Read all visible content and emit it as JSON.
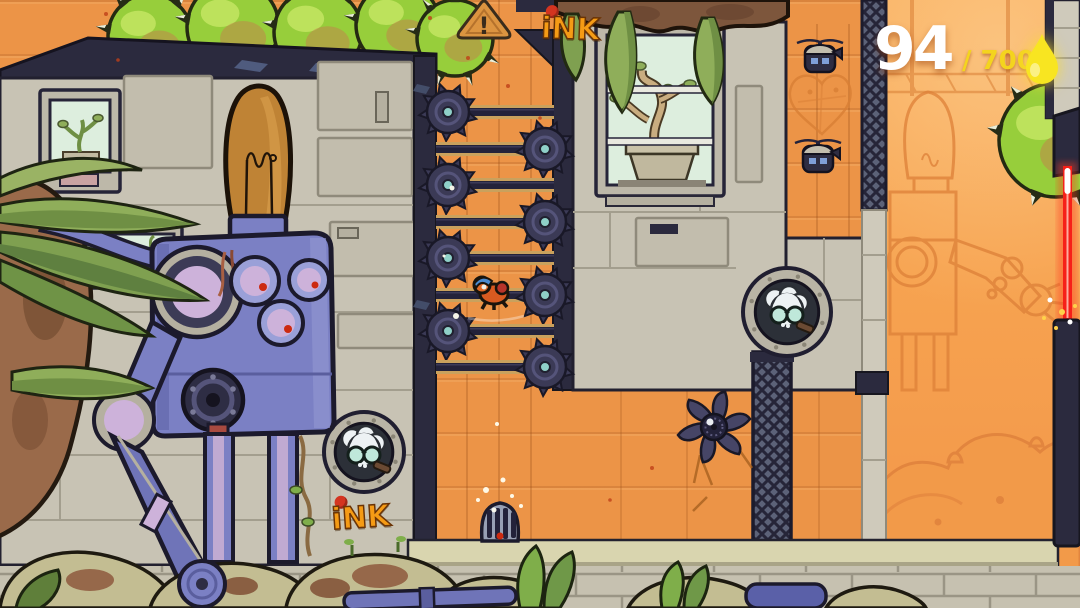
{
  "hud": {
    "ink_count": "94",
    "ink_total": "/ 700",
    "count_color": "#ffffff",
    "total_color": "#f4d41e",
    "droplet_color": "#f8e521"
  },
  "branding": {
    "ink_logo_text": "iNK",
    "ink_logo_color": "#f59b15",
    "ink_logo_dot_color": "#d43420"
  },
  "signs": {
    "warning_text": "!"
  },
  "level": {
    "rails": [
      {
        "y": 112,
        "saw": "left"
      },
      {
        "y": 149,
        "saw": "right"
      },
      {
        "y": 185,
        "saw": "left"
      },
      {
        "y": 222,
        "saw": "right"
      },
      {
        "y": 258,
        "saw": "left"
      },
      {
        "y": 295,
        "saw": "right"
      },
      {
        "y": 331,
        "saw": "left"
      },
      {
        "y": 367,
        "saw": "right"
      }
    ],
    "player": {
      "x": 472,
      "y": 272
    },
    "drones": [
      {
        "x": 797,
        "y": 36
      },
      {
        "x": 795,
        "y": 136
      }
    ],
    "skull_windows": [
      {
        "cx": 364,
        "cy": 452,
        "r": 40
      },
      {
        "cx": 787,
        "cy": 312,
        "r": 44
      }
    ],
    "green_blobs": [
      {
        "cx": 150,
        "cy": 36,
        "r": 42
      },
      {
        "cx": 233,
        "cy": 27,
        "r": 46
      },
      {
        "cx": 318,
        "cy": 32,
        "r": 44
      },
      {
        "cx": 398,
        "cy": 25,
        "r": 42
      },
      {
        "cx": 455,
        "cy": 38,
        "r": 38
      },
      {
        "cx": 1056,
        "cy": 140,
        "r": 57
      }
    ],
    "sparkles": [
      {
        "x": 452,
        "y": 188,
        "r": 2.5
      },
      {
        "x": 456,
        "y": 316,
        "r": 3
      },
      {
        "x": 444,
        "y": 256,
        "r": 1.5
      },
      {
        "x": 497,
        "y": 424,
        "r": 2
      },
      {
        "x": 486,
        "y": 490,
        "r": 3
      },
      {
        "x": 503,
        "y": 480,
        "r": 2.5
      },
      {
        "x": 512,
        "y": 496,
        "r": 2
      },
      {
        "x": 478,
        "y": 500,
        "r": 2
      },
      {
        "x": 494,
        "y": 510,
        "r": 2.5
      },
      {
        "x": 521,
        "y": 506,
        "r": 2
      }
    ],
    "laser_sparks": [
      {
        "x": 1050,
        "y": 300,
        "r": 2.5
      },
      {
        "x": 1062,
        "y": 312,
        "r": 3
      },
      {
        "x": 1044,
        "y": 318,
        "r": 2
      },
      {
        "x": 1070,
        "y": 322,
        "r": 2.5
      },
      {
        "x": 1056,
        "y": 328,
        "r": 2
      },
      {
        "x": 1075,
        "y": 306,
        "r": 2
      }
    ]
  },
  "palette": {
    "wall_orange": "#ec9447",
    "room_orange": "#f7a450",
    "steel_navy": "#2b2a3e",
    "stone_grey": "#c8c3b4",
    "floor_khaki": "#d9d5af",
    "robot_purple": "#7b80c4",
    "bulb_amber": "#bf8335",
    "plant_green": "#97ce3b",
    "laser_red": "#f62018",
    "screen_mint": "#ddeede"
  }
}
